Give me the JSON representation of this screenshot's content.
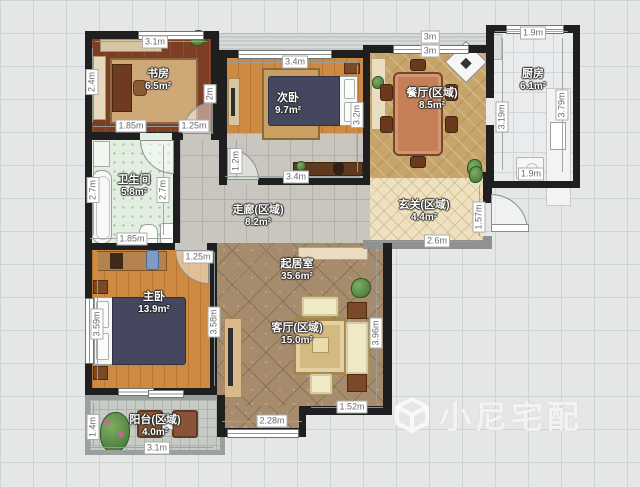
{
  "watermark": {
    "brand": "小尼宅配",
    "logo": "cube-logo"
  },
  "rooms": {
    "study": {
      "name": "书房",
      "area": "6.5m²"
    },
    "bedroom2": {
      "name": "次卧",
      "area": "9.7m²"
    },
    "dining": {
      "name": "餐厅(区域)",
      "area": "8.5m²"
    },
    "kitchen": {
      "name": "厨房",
      "area": "6.1m²"
    },
    "bathroom": {
      "name": "卫生间",
      "area": "5.8m²"
    },
    "corridor": {
      "name": "走廊(区域)",
      "area": "8.2m²"
    },
    "entrance": {
      "name": "玄关(区域)",
      "area": "4.4m²"
    },
    "master": {
      "name": "主卧",
      "area": "13.9m²"
    },
    "living_zone": {
      "name": "起居室",
      "area": "35.6m²"
    },
    "livingroom": {
      "name": "客厅(区域)",
      "area": "15.0m²"
    },
    "balcony": {
      "name": "阳台(区域)",
      "area": "4.0m²"
    }
  },
  "dims": {
    "study_top": "3.1m",
    "study_left": "2.4m",
    "study_right": "2m",
    "study_bottom_l": "1.85m",
    "study_bottom_r": "1.25m",
    "bed2_top": "3.4m",
    "bed2_right": "3.2m",
    "bed2_bottom_l": "1.2m",
    "bed2_bottom": "3.4m",
    "dining_top1": "3m",
    "dining_top2": "3m",
    "kitchen_top": "1.9m",
    "kitchen_left": "3.19m",
    "kitchen_right": "3.79m",
    "kitchen_bottom": "1.9m",
    "bath_left": "2.7m",
    "bath_right": "2.7m",
    "bath_bottom": "1.85m",
    "corridor_left": "1.25m",
    "entr_right": "1.57m",
    "entr_bottom": "2.6m",
    "master_left": "3.59m",
    "master_right": "3.58m",
    "living_right": "3.96m",
    "living_bottom_r": "1.52m",
    "living_bottom_l": "2.28m",
    "balcony_left": "1.4m",
    "balcony_bottom": "3.1m"
  },
  "colors": {
    "wall": "#1f1f1f",
    "study_floor": "#7d3f24",
    "bedroom_floor": "#cd8a40",
    "dining_floor": "#c7a46a",
    "kitchen_floor": "#e9ebec",
    "bath_floor": "#e2efe0",
    "corridor_floor": "#c9c5bf",
    "entrance_floor": "#eee1c1",
    "living_floor": "#a78b6d",
    "balcony_floor": "#c6cbc6",
    "bed_duvet": "#44475e",
    "sofa": "#f0e9c8"
  }
}
